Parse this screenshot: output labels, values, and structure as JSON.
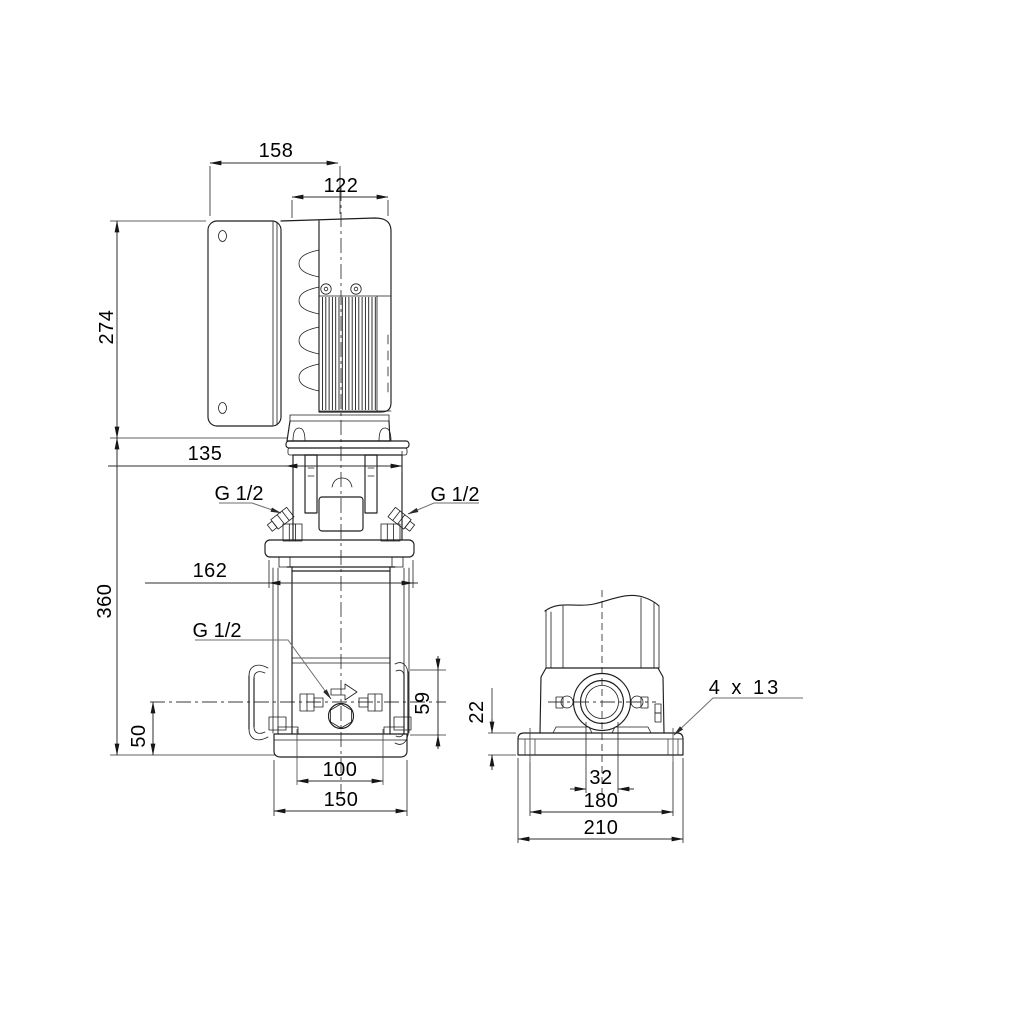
{
  "labels": {
    "front": {
      "overall_width": "158",
      "motor_width": "122",
      "motor_height": "274",
      "adapter_width": "135",
      "port_left": "G 1/2",
      "port_right": "G 1/2",
      "head_width": "162",
      "pump_height": "360",
      "drain_port": "G 1/2",
      "port_axis_to_base": "50",
      "port_flange_height": "59",
      "base_hole_spacing": "100",
      "base_width": "150"
    },
    "side": {
      "plate_thickness": "22",
      "port_bore": "32",
      "hole_spacing": "180",
      "plate_width": "210",
      "mounting_holes": "4 x 13"
    }
  }
}
